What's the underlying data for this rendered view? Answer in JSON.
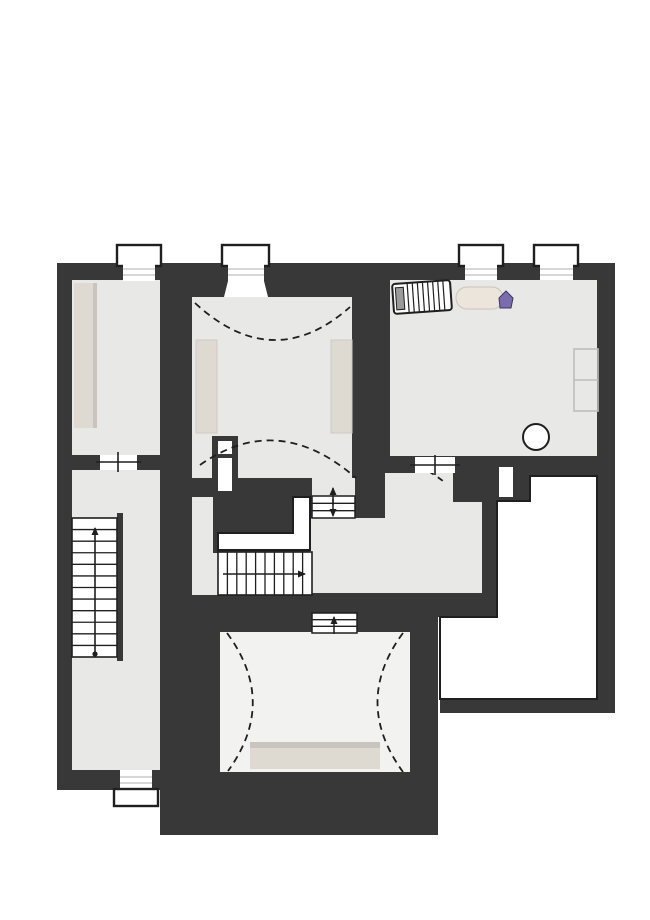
{
  "meta": {
    "title": "attic-floor-plan",
    "canvas_width": 650,
    "canvas_height": 920
  },
  "palette": {
    "wall": "#383838",
    "line": "#1f1f1f",
    "floor": "#e8e8e7",
    "floorLight": "#f2f2f1",
    "white": "#ffffff",
    "beige": "#ded9d1",
    "beigeDeep": "#c9c5be",
    "grayline": "#bfbfbf",
    "lightstroke": "#bdbdbd",
    "furnstroke": "#cfcac3",
    "metal": "#9a9a9a",
    "purple": "#7b6cae",
    "purpleDark": "#3f3560"
  },
  "plan": {
    "items": [
      {
        "t": "rect",
        "n": "footprint-top",
        "x": 57,
        "y": 263,
        "w": 558,
        "h": 210,
        "f": "$wall"
      },
      {
        "t": "rect",
        "n": "footprint-left-wing",
        "x": 57,
        "y": 263,
        "w": 135,
        "h": 527,
        "f": "$wall"
      },
      {
        "t": "rect",
        "n": "footprint-center-wing",
        "x": 160,
        "y": 473,
        "w": 278,
        "h": 362,
        "f": "$wall"
      },
      {
        "t": "rect",
        "n": "footprint-hall-block",
        "x": 352,
        "y": 473,
        "w": 145,
        "h": 144,
        "f": "$wall"
      },
      {
        "t": "rect",
        "n": "footprint-right-wing",
        "x": 440,
        "y": 263,
        "w": 175,
        "h": 450,
        "f": "$wall"
      },
      {
        "t": "rect",
        "n": "room-left-floor",
        "x": 72,
        "y": 280,
        "w": 88,
        "h": 175,
        "f": "$floor"
      },
      {
        "t": "rect",
        "n": "corridor-floor",
        "x": 72,
        "y": 470,
        "w": 88,
        "h": 300,
        "f": "$floor"
      },
      {
        "t": "rect",
        "n": "room-middle-floor",
        "x": 192,
        "y": 297,
        "w": 160,
        "h": 181,
        "f": "$floor"
      },
      {
        "t": "rect",
        "n": "room-right-floor",
        "x": 390,
        "y": 280,
        "w": 207,
        "h": 176,
        "f": "$floor"
      },
      {
        "t": "rect",
        "n": "stairwell-side-strip",
        "x": 192,
        "y": 497,
        "w": 26,
        "h": 98,
        "f": "$floor"
      },
      {
        "t": "rect",
        "n": "flight-top-approach-floor",
        "x": 312,
        "y": 478,
        "w": 43,
        "h": 19,
        "f": "$floor"
      },
      {
        "t": "rect",
        "n": "hall-floor",
        "x": 385,
        "y": 473,
        "w": 68,
        "h": 45,
        "f": "$floor"
      },
      {
        "t": "rect",
        "n": "hall-floor-east",
        "x": 453,
        "y": 502,
        "w": 29,
        "h": 16,
        "f": "$floor"
      },
      {
        "t": "rect",
        "n": "landing-floor",
        "x": 310,
        "y": 518,
        "w": 172,
        "h": 75,
        "f": "$floor"
      },
      {
        "t": "rect",
        "n": "room-bottom-floor",
        "x": 220,
        "y": 632,
        "w": 190,
        "h": 140,
        "f": "$floorLight"
      },
      {
        "t": "poly",
        "n": "void-open-below",
        "pts": "530,476 597,476 597,699 440,699 440,617 497,617 497,501 530,501",
        "f": "$white",
        "s": "$line",
        "sw": 2
      },
      {
        "t": "rect",
        "n": "wall-niche",
        "x": 499,
        "y": 467,
        "w": 14,
        "h": 30,
        "f": "$white"
      },
      {
        "t": "rect",
        "n": "stair-opening-well",
        "x": 213,
        "y": 497,
        "w": 97,
        "h": 56,
        "f": "$wall"
      },
      {
        "t": "poly",
        "n": "stair-upper-flight-outline",
        "pts": "218,533 293,533 293,497 310,497 310,550 218,550",
        "f": "$white",
        "s": "$line",
        "sw": 2
      },
      {
        "t": "rect",
        "n": "stair-main-run",
        "x": 218,
        "y": 552,
        "w": 94,
        "h": 43,
        "f": "$white",
        "s": "$line",
        "sw": 1.6
      },
      {
        "t": "treads",
        "n": "stair-main-treads",
        "x": 218,
        "y": 552,
        "w": 94,
        "h": 43,
        "count": 9,
        "dir": "v",
        "s": "$line",
        "sw": 1.3
      },
      {
        "t": "arrow",
        "n": "stair-main-direction-arrow",
        "x1": 223,
        "y1": 574,
        "x2": 305,
        "y2": 574,
        "s": "$line",
        "sw": 1.6
      },
      {
        "t": "rect",
        "n": "stair-left-stringer",
        "x": 117,
        "y": 513,
        "w": 6,
        "h": 148,
        "f": "$wall"
      },
      {
        "t": "rect",
        "n": "stair-left-run",
        "x": 72,
        "y": 518,
        "w": 45,
        "h": 139,
        "f": "$white",
        "s": "$line",
        "sw": 1.6
      },
      {
        "t": "treads",
        "n": "stair-left-treads",
        "x": 72,
        "y": 518,
        "w": 45,
        "h": 139,
        "count": 11,
        "dir": "h",
        "s": "$line",
        "sw": 1.3
      },
      {
        "t": "arrow",
        "n": "stair-left-direction-arrow",
        "x1": 95,
        "y1": 652,
        "x2": 95,
        "y2": 528,
        "s": "$line",
        "sw": 1.6
      },
      {
        "t": "circle",
        "n": "stair-left-start-dot",
        "cx": 95,
        "cy": 654,
        "r": 2.6,
        "f": "$line"
      },
      {
        "t": "rect",
        "n": "flight-top-steps",
        "x": 312,
        "y": 496,
        "w": 43,
        "h": 22,
        "f": "$white",
        "s": "$line",
        "sw": 1.5
      },
      {
        "t": "treads",
        "n": "flight-top-treads",
        "x": 312,
        "y": 496,
        "w": 43,
        "h": 22,
        "count": 2,
        "dir": "h",
        "s": "$line",
        "sw": 1.3
      },
      {
        "t": "arrow",
        "n": "flight-top-arrow-up",
        "x1": 333,
        "y1": 505,
        "x2": 333,
        "y2": 488,
        "s": "$line",
        "sw": 1.5
      },
      {
        "t": "arrow",
        "n": "flight-top-arrow-down",
        "x1": 333,
        "y1": 499,
        "x2": 333,
        "y2": 516,
        "s": "$line",
        "sw": 1.5
      },
      {
        "t": "rect",
        "n": "flight-bottom-steps",
        "x": 312,
        "y": 613,
        "w": 45,
        "h": 20,
        "f": "$white",
        "s": "$line",
        "sw": 1.5
      },
      {
        "t": "treads",
        "n": "flight-bottom-treads",
        "x": 312,
        "y": 613,
        "w": 45,
        "h": 20,
        "count": 2,
        "dir": "h",
        "s": "$line",
        "sw": 1.3
      },
      {
        "t": "arrow",
        "n": "flight-bottom-arrow-up",
        "x1": 334,
        "y1": 634,
        "x2": 334,
        "y2": 617,
        "s": "$line",
        "sw": 1.5
      },
      {
        "t": "rect",
        "n": "chimney",
        "x": 212,
        "y": 436,
        "w": 26,
        "h": 60,
        "f": "$wall"
      },
      {
        "t": "rect",
        "n": "chimney-flue-small",
        "x": 218,
        "y": 441,
        "w": 14,
        "h": 13,
        "f": "$white"
      },
      {
        "t": "rect",
        "n": "chimney-flue-large",
        "x": 218,
        "y": 458,
        "w": 14,
        "h": 33,
        "f": "$white"
      },
      {
        "t": "rect",
        "n": "bed-platform-shadow",
        "x": 250,
        "y": 742,
        "w": 130,
        "h": 8,
        "f": "$beigeDeep"
      },
      {
        "t": "rect",
        "n": "bed-platform",
        "x": 250,
        "y": 748,
        "w": 130,
        "h": 21,
        "f": "$beige"
      },
      {
        "t": "path",
        "n": "roofline-arc-middle-top",
        "d": "M195,303 Q273,375 350,307",
        "s": "$line",
        "sw": 1.8,
        "dash": "7 5"
      },
      {
        "t": "path",
        "n": "roofline-arc-middle-bottom",
        "d": "M200,465 Q278,410 356,478",
        "s": "$line",
        "sw": 1.8,
        "dash": "7 5"
      },
      {
        "t": "path",
        "n": "roofline-arc-hall",
        "d": "M419,466 Q431,472 443,481",
        "s": "$line",
        "sw": 1.8,
        "dash": "6 5"
      },
      {
        "t": "path",
        "n": "roofline-arc-bottom-left",
        "d": "M227,633 Q278,702 228,771",
        "s": "$line",
        "sw": 1.8,
        "dash": "7 5"
      },
      {
        "t": "path",
        "n": "roofline-arc-bottom-right",
        "d": "M403,633 Q352,702 403,772",
        "s": "$line",
        "sw": 1.8,
        "dash": "7 5"
      },
      {
        "t": "rect",
        "n": "window-frame-1",
        "x": 117,
        "y": 245,
        "w": 44,
        "h": 21,
        "f": "$white",
        "s": "$line",
        "sw": 2.4
      },
      {
        "t": "rect",
        "n": "window-band-1",
        "x": 123,
        "y": 264,
        "w": 32,
        "h": 17,
        "f": "$white"
      },
      {
        "t": "line",
        "n": "window-sill-1a",
        "x1": 123,
        "y1": 269,
        "x2": 155,
        "y2": 269,
        "s": "$grayline",
        "sw": 1.2
      },
      {
        "t": "line",
        "n": "window-sill-1b",
        "x1": 123,
        "y1": 275,
        "x2": 155,
        "y2": 275,
        "s": "$grayline",
        "sw": 1.2
      },
      {
        "t": "rect",
        "n": "window-frame-2",
        "x": 222,
        "y": 245,
        "w": 47,
        "h": 21,
        "f": "$white",
        "s": "$line",
        "sw": 2.4
      },
      {
        "t": "rect",
        "n": "window-band-2",
        "x": 228,
        "y": 264,
        "w": 36,
        "h": 18,
        "f": "$white"
      },
      {
        "t": "poly",
        "n": "window-splay-2",
        "pts": "228,281 264,281 268,297 224,297",
        "f": "$white"
      },
      {
        "t": "line",
        "n": "window-sill-2a",
        "x1": 228,
        "y1": 269,
        "x2": 264,
        "y2": 269,
        "s": "$grayline",
        "sw": 1.2
      },
      {
        "t": "line",
        "n": "window-sill-2b",
        "x1": 228,
        "y1": 275,
        "x2": 264,
        "y2": 275,
        "s": "$grayline",
        "sw": 1.2
      },
      {
        "t": "rect",
        "n": "window-frame-3",
        "x": 459,
        "y": 245,
        "w": 44,
        "h": 21,
        "f": "$white",
        "s": "$line",
        "sw": 2.4
      },
      {
        "t": "rect",
        "n": "window-band-3",
        "x": 465,
        "y": 264,
        "w": 32,
        "h": 16,
        "f": "$white"
      },
      {
        "t": "line",
        "n": "window-sill-3a",
        "x1": 465,
        "y1": 269,
        "x2": 497,
        "y2": 269,
        "s": "$grayline",
        "sw": 1.2
      },
      {
        "t": "line",
        "n": "window-sill-3b",
        "x1": 465,
        "y1": 275,
        "x2": 497,
        "y2": 275,
        "s": "$grayline",
        "sw": 1.2
      },
      {
        "t": "rect",
        "n": "window-frame-4",
        "x": 534,
        "y": 245,
        "w": 44,
        "h": 21,
        "f": "$white",
        "s": "$line",
        "sw": 2.4
      },
      {
        "t": "rect",
        "n": "window-band-4",
        "x": 540,
        "y": 264,
        "w": 33,
        "h": 16,
        "f": "$white"
      },
      {
        "t": "line",
        "n": "window-sill-4a",
        "x1": 540,
        "y1": 269,
        "x2": 573,
        "y2": 269,
        "s": "$grayline",
        "sw": 1.2
      },
      {
        "t": "line",
        "n": "window-sill-4b",
        "x1": 540,
        "y1": 275,
        "x2": 573,
        "y2": 275,
        "s": "$grayline",
        "sw": 1.2
      },
      {
        "t": "rect",
        "n": "window-band-5",
        "x": 120,
        "y": 770,
        "w": 32,
        "h": 20,
        "f": "$white"
      },
      {
        "t": "line",
        "n": "window-sill-5a",
        "x1": 120,
        "y1": 777,
        "x2": 152,
        "y2": 777,
        "s": "$grayline",
        "sw": 1.2
      },
      {
        "t": "line",
        "n": "window-sill-5b",
        "x1": 120,
        "y1": 783,
        "x2": 152,
        "y2": 783,
        "s": "$grayline",
        "sw": 1.2
      },
      {
        "t": "rect",
        "n": "window-frame-5",
        "x": 114,
        "y": 789,
        "w": 44,
        "h": 17,
        "f": "$white",
        "s": "$line",
        "sw": 2.4
      },
      {
        "t": "rect",
        "n": "door-gap-left-room",
        "x": 100,
        "y": 455,
        "w": 37,
        "h": 15,
        "f": "$white"
      },
      {
        "t": "line",
        "n": "door-line-left-room",
        "x1": 96,
        "y1": 462,
        "x2": 141,
        "y2": 462,
        "s": "$line",
        "sw": 1.6
      },
      {
        "t": "line",
        "n": "door-tick-left-room",
        "x1": 118,
        "y1": 452,
        "x2": 118,
        "y2": 472,
        "s": "$line",
        "sw": 1.6
      },
      {
        "t": "rect",
        "n": "door-gap-right-room",
        "x": 415,
        "y": 457,
        "w": 40,
        "h": 16,
        "f": "$white"
      },
      {
        "t": "line",
        "n": "door-line-right-room",
        "x1": 410,
        "y1": 465,
        "x2": 460,
        "y2": 465,
        "s": "$line",
        "sw": 1.6
      },
      {
        "t": "line",
        "n": "door-tick-right-room",
        "x1": 435,
        "y1": 455,
        "x2": 435,
        "y2": 475,
        "s": "$line",
        "sw": 1.6
      },
      {
        "t": "rect",
        "n": "shelf-left-room",
        "x": 74,
        "y": 283,
        "w": 22,
        "h": 145,
        "f": "$beige"
      },
      {
        "t": "rect",
        "n": "shelf-left-room-shadow",
        "x": 93,
        "y": 283,
        "w": 4,
        "h": 145,
        "f": "$beigeDeep"
      },
      {
        "t": "rect",
        "n": "kneewall-middle-left",
        "x": 196,
        "y": 340,
        "w": 21,
        "h": 93,
        "f": "$beige",
        "s": "$furnstroke",
        "sw": 1
      },
      {
        "t": "rect",
        "n": "kneewall-middle-right",
        "x": 331,
        "y": 340,
        "w": 21,
        "h": 93,
        "f": "$beige",
        "s": "$furnstroke",
        "sw": 1
      },
      {
        "t": "group",
        "n": "radiator",
        "tf": "rotate(-4 422 297)",
        "ch": [
          {
            "t": "rect",
            "n": "radiator-body",
            "x": 393,
            "y": 282,
            "w": 58,
            "h": 30,
            "rx": 3,
            "f": "$white",
            "s": "$line",
            "sw": 2
          },
          {
            "t": "rect",
            "n": "radiator-valve",
            "x": 396,
            "y": 286,
            "w": 8,
            "h": 22,
            "f": "$metal",
            "s": "$line",
            "sw": 1
          },
          {
            "t": "treads",
            "n": "radiator-fins",
            "x": 403,
            "y": 282,
            "w": 46,
            "h": 30,
            "count": 8,
            "dir": "v",
            "s": "$line",
            "sw": 1.2
          }
        ]
      },
      {
        "t": "rect",
        "n": "bolster-cushion",
        "x": 456,
        "y": 287,
        "w": 47,
        "h": 22,
        "rx": 11,
        "f": "#ece5db",
        "s": "#d0c9c0",
        "sw": 1.2
      },
      {
        "t": "poly",
        "n": "marker-north-icon",
        "pts": "506,291 513,298 511,308 500,308 499,298",
        "f": "$purple",
        "s": "$purpleDark",
        "sw": 1
      },
      {
        "t": "rect",
        "n": "wardrobe-outline",
        "x": 574,
        "y": 349,
        "w": 24,
        "h": 62,
        "f": "none",
        "s": "$lightstroke",
        "sw": 1.6
      },
      {
        "t": "line",
        "n": "wardrobe-divider",
        "x1": 574,
        "y1": 380,
        "x2": 598,
        "y2": 380,
        "s": "$lightstroke",
        "sw": 1.6
      },
      {
        "t": "circle",
        "n": "stool-circle",
        "cx": 536,
        "cy": 437,
        "r": 13,
        "f": "$white",
        "s": "$line",
        "sw": 2
      }
    ]
  }
}
